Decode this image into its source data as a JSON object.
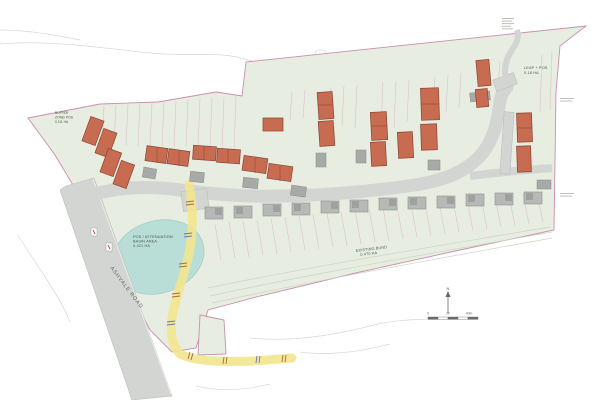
{
  "labels": {
    "buffer_zone": {
      "l1": "BUFFER",
      "l2": "ZONE/ POS",
      "l3": "0.111 HA"
    },
    "leap_pos": {
      "l1": "LEAP + POS",
      "l2": "0.18 HA"
    },
    "attenuation_basin": {
      "l1": "POS / ATTENUATION",
      "l2": "BASIN AREA",
      "l3": "0.321 HA"
    },
    "existing_bund": {
      "l1": "EXISTING BUND",
      "l2": "0.470 HA"
    },
    "ashvale_road": "ASHVALE ROAD",
    "north_arrow": "N",
    "scale_bar": {
      "t0": "0",
      "t20": "20",
      "t40": "40m"
    }
  },
  "colors": {
    "site_green": "#e7ede1",
    "boundary_pink": "#c990ae",
    "parcel_pink": "#ddc0cb",
    "road_gray": "#d3d5d3",
    "house_red": "#c76b51",
    "house_red_outline": "#8a4433",
    "existing_house_gray": "#b7b9b7",
    "pond_teal": "#b9ded7",
    "path_yellow": "#f2e58e",
    "label_green": "#45584c",
    "sketch_gray": "#d9d9d3"
  }
}
